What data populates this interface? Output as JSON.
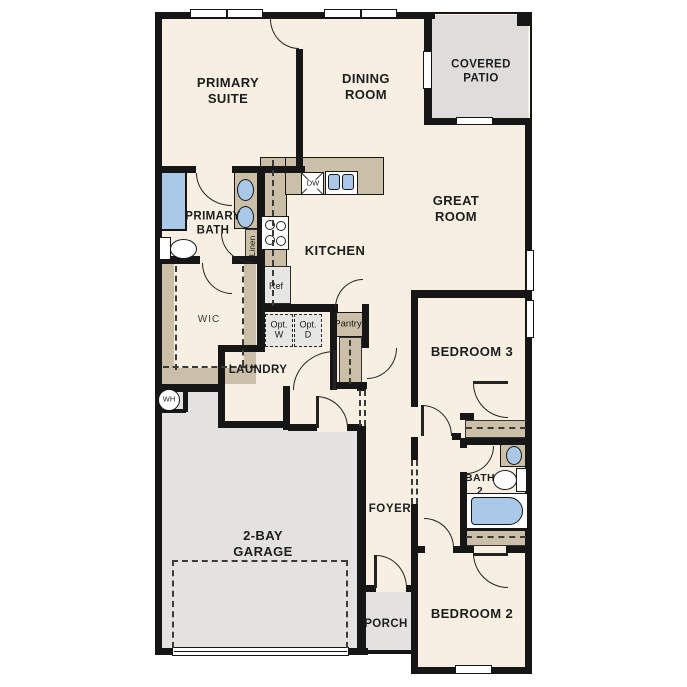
{
  "rooms": {
    "primary_suite": "PRIMARY\nSUITE",
    "dining_room": "DINING\nROOM",
    "covered_patio": "COVERED\nPATIO",
    "great_room": "GREAT\nROOM",
    "primary_bath": "PRIMARY\nBATH",
    "kitchen": "KITCHEN",
    "wic": "WIC",
    "laundry": "LAUNDRY",
    "garage": "2-BAY\nGARAGE",
    "foyer": "FOYER",
    "porch": "PORCH",
    "bath_2": "BATH\n2",
    "bedroom_3": "BEDROOM 3",
    "bedroom_2": "BEDROOM 2"
  },
  "fixtures": {
    "dishwasher": "DW",
    "refrigerator": "Ref",
    "optional_washer": "Opt.\nW",
    "optional_dryer": "Opt.\nD",
    "pantry": "Pantry",
    "linen": "Linen",
    "water_heater": "WH"
  },
  "colors": {
    "wall": "#161616",
    "floor": "#f7f0e2",
    "tan": "#cbbfa7",
    "garage": "#e3e2e0",
    "patio": "#dedddb",
    "chip": "#e6e6e4",
    "blue": "#aac9e8",
    "arc": "#232323",
    "ink": "#1d1d1d"
  }
}
